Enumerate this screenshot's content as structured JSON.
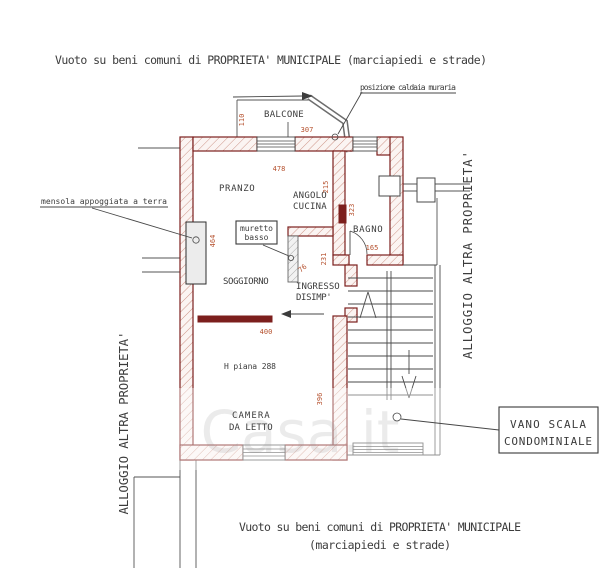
{
  "titles": {
    "top": "Vuoto su beni comuni di PROPRIETA' MUNICIPALE (marciapiedi e strade)",
    "bottom1": "Vuoto su beni comuni di PROPRIETA' MUNICIPALE",
    "bottom2": "(marciapiedi e strade)"
  },
  "side": {
    "left": "ALLOGGIO ALTRA PROPRIETA'",
    "right": "ALLOGGIO ALTRA PROPRIETA'"
  },
  "rooms": {
    "balcone": "BALCONE",
    "pranzo": "PRANZO",
    "cucina1": "ANGOLO",
    "cucina2": "CUCINA",
    "bagno": "BAGNO",
    "soggiorno": "SOGGIORNO",
    "ingresso1": "INGRESSO",
    "ingresso2": "DISIMP'",
    "camera1": "CAMERA",
    "camera2": "DA LETTO",
    "h_piana": "H piana 288"
  },
  "notes": {
    "caldaia": "posizione caldaia muraria",
    "mensola": "mensola appoggiata a terra",
    "muretto1": "muretto",
    "muretto2": "basso",
    "vano1": "VANO SCALA",
    "vano2": "CONDOMINIALE"
  },
  "dims": {
    "balcone_h": "110",
    "balcone_w": "307",
    "pranzo_w": "478",
    "cucina_h": "215",
    "bagno_wall": "323",
    "bagno_w": "165",
    "disimp_w": "76",
    "disimp_h": "231",
    "camera_w": "400",
    "camera_h": "396",
    "mensola_wall": "464"
  },
  "watermark": "Casa.it",
  "colors": {
    "wall": "#7c1f1d",
    "hatch": "#c27b6c",
    "dim": "#b5502d",
    "ink": "#3c3c3c",
    "line": "#555555"
  }
}
